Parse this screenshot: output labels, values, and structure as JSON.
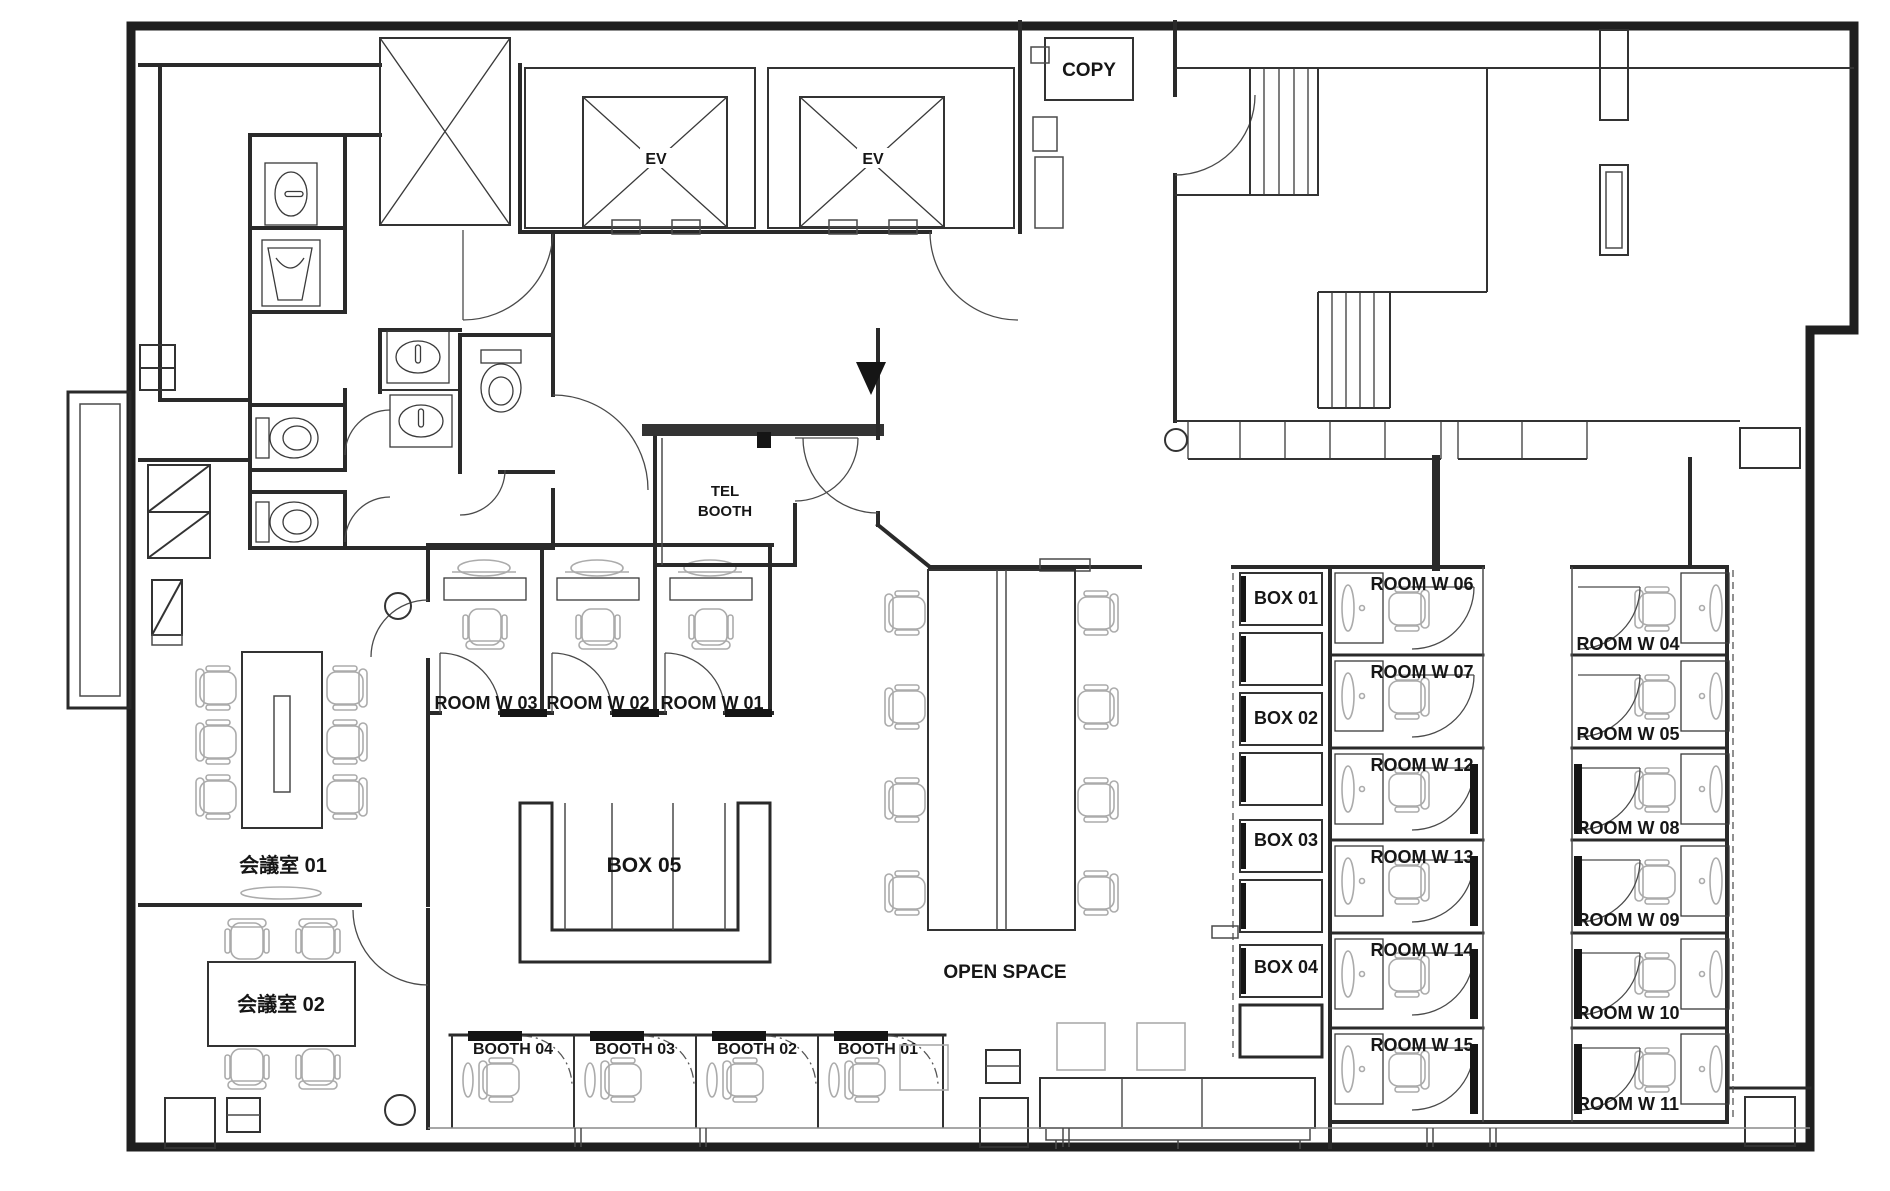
{
  "plan": {
    "type": "office-floor-plan",
    "copy": "COPY",
    "ev": "EV",
    "tel_booth": [
      "TEL",
      "BOOTH"
    ],
    "open_space": "OPEN SPACE",
    "meeting_rooms": [
      "会議室 01",
      "会議室 02"
    ],
    "box_lounge": "BOX 05",
    "small_rooms": [
      "ROOM W 03",
      "ROOM W 02",
      "ROOM W 01"
    ],
    "booths": [
      "BOOTH 04",
      "BOOTH 03",
      "BOOTH 02",
      "BOOTH 01"
    ],
    "boxes": [
      "BOX 01",
      "BOX 02",
      "BOX 03",
      "BOX 04"
    ],
    "rooms_center": [
      "ROOM W 06",
      "ROOM W 07",
      "ROOM W 12",
      "ROOM W 13",
      "ROOM W 14",
      "ROOM W 15"
    ],
    "rooms_right": [
      "ROOM W 04",
      "ROOM W 05",
      "ROOM W 08",
      "ROOM W 09",
      "ROOM W 10",
      "ROOM W 11"
    ]
  },
  "colors": {
    "wall": "#1f1f1f",
    "partition": "#333333",
    "furniture": "#ababab",
    "door_black": "#151515",
    "background": "#ffffff"
  }
}
